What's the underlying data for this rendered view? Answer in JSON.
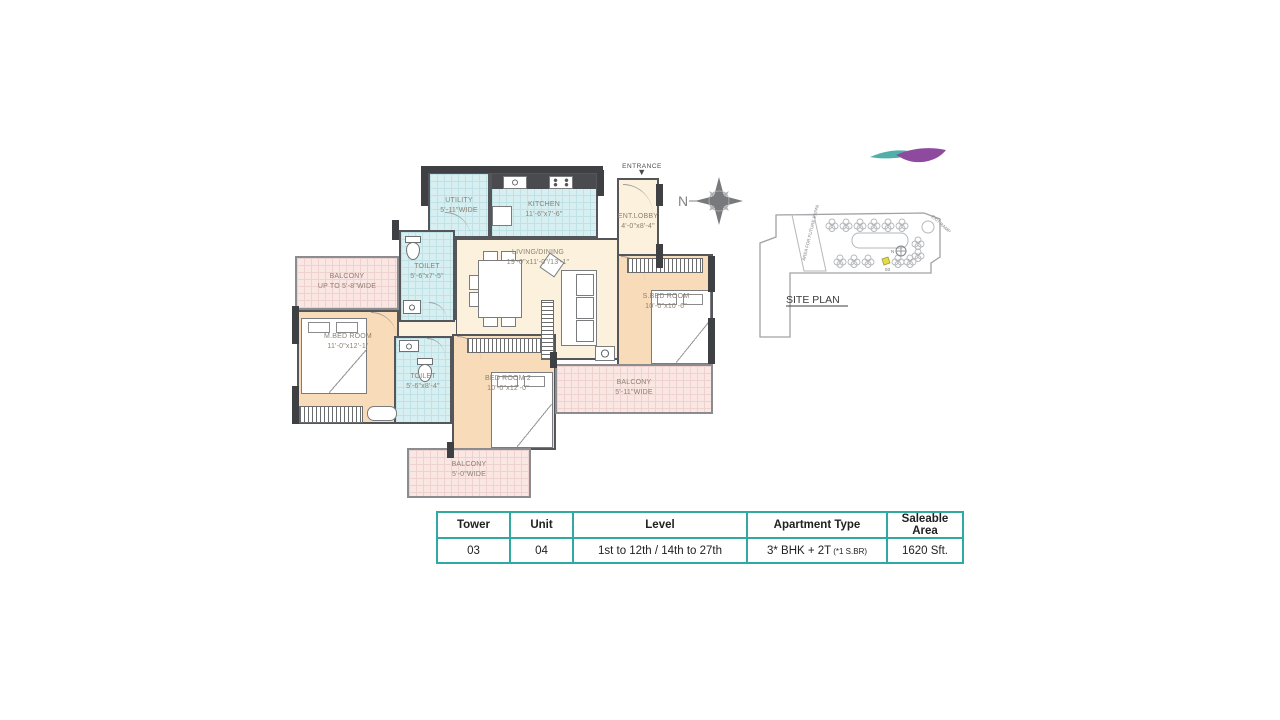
{
  "plan": {
    "entrance_label": "ENTRANCE",
    "rooms": {
      "utility": {
        "name": "UTILITY",
        "dim": "5'-11\"WIDE"
      },
      "kitchen": {
        "name": "KITCHEN",
        "dim": "11'-6\"x7'-6\""
      },
      "ent_lobby": {
        "name": "ENT.LOBBY",
        "dim": "4'-0\"x8'-4\""
      },
      "living": {
        "name": "LIVING/DINING",
        "dim": "19'-0\"x11'-0\"/13'-1\""
      },
      "toilet1": {
        "name": "TOILET",
        "dim": "5'-6\"x7'-5\""
      },
      "toilet2": {
        "name": "TOILET",
        "dim": "5'-6\"x8'-4\""
      },
      "m_bed": {
        "name": "M.BED ROOM",
        "dim": "11'-0\"x12'-1\""
      },
      "bed2": {
        "name": "BED ROOM 2",
        "dim": "10'-0\"x12'-0\""
      },
      "s_bed": {
        "name": "S.BED ROOM",
        "dim": "10'-0\"x10'-6\""
      },
      "balcony_left": {
        "name": "BALCONY",
        "dim": "UP TO 5'-8\"WIDE"
      },
      "balcony_right": {
        "name": "BALCONY",
        "dim": "5'-11\"WIDE"
      },
      "balcony_bottom": {
        "name": "BALCONY",
        "dim": "5'-0\"WIDE"
      }
    }
  },
  "compass": {
    "north_label": "N"
  },
  "site_plan": {
    "title": "SITE PLAN",
    "area_future": "AREA FOR FUTURE EXPANSION",
    "exit_ramp": "EXIT RAMP",
    "unit_label": "03",
    "north_label": "N"
  },
  "table": {
    "headers": [
      "Tower",
      "Unit",
      "Level",
      "Apartment Type",
      "Saleable Area"
    ],
    "row": {
      "tower": "03",
      "unit": "04",
      "level": "1st to 12th / 14th to 27th",
      "apartment_type": "3* BHK + 2T",
      "apartment_type_note": "(*1 S.BR)",
      "saleable_area": "1620 Sft."
    }
  },
  "colors": {
    "table_border": "#2fa9a2",
    "wall_dark": "#3f4043",
    "wall": "#55565a",
    "bedroom_fill": "#f8dcba",
    "living_fill": "#fbf1dc",
    "wet_area_fill": "#d7eff1",
    "balcony_fill": "#fae6e3",
    "label_text": "#8b8173",
    "logo_teal": "#4fb0ab",
    "logo_purple": "#8e4a9e"
  }
}
